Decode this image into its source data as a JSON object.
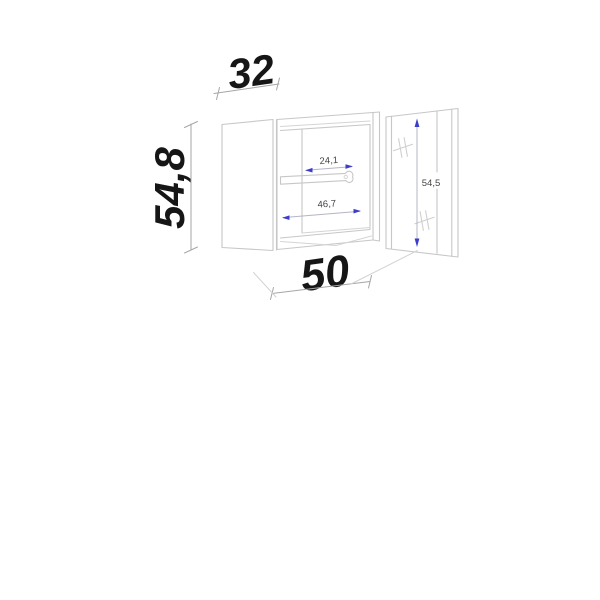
{
  "drawing": {
    "type": "furniture-technical-drawing",
    "subject": "wall cabinet with open door, interior shelf and hinge marks"
  },
  "dimensions": {
    "top_width": "32",
    "left_height": "54,8",
    "bottom_width": "50",
    "interior_upper": "24,1",
    "interior_lower": "46,7",
    "door_height": "54,5"
  },
  "colors": {
    "background": "#ffffff",
    "outline": "#c7c7c7",
    "dimension_line": "#a6a6a6",
    "dimension_text": "#161616",
    "small_text": "#454545",
    "accent_blue": "#3d3dcb"
  }
}
